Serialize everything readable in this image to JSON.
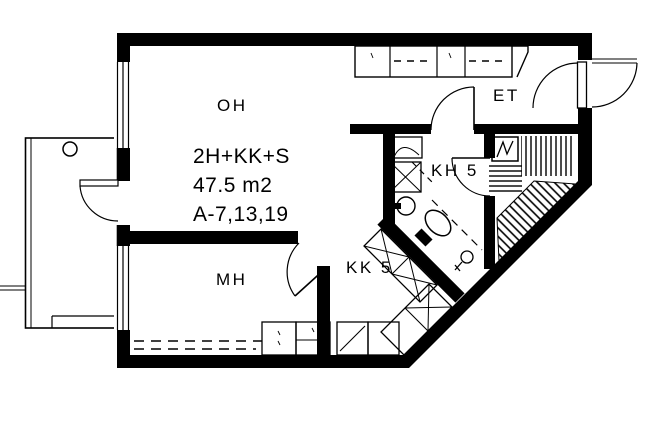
{
  "plan": {
    "title_block": {
      "apartment_type": "2H+KK+S",
      "area": "47.5 m2",
      "apartment_numbers": "A-7,13,19"
    },
    "rooms": {
      "living_room": "OH",
      "bedroom": "MH",
      "entry_hall": "ET",
      "bathroom": "KH 5",
      "kitchenette": "KK 5"
    },
    "colors": {
      "ink": "#000000",
      "paper": "#ffffff"
    }
  }
}
